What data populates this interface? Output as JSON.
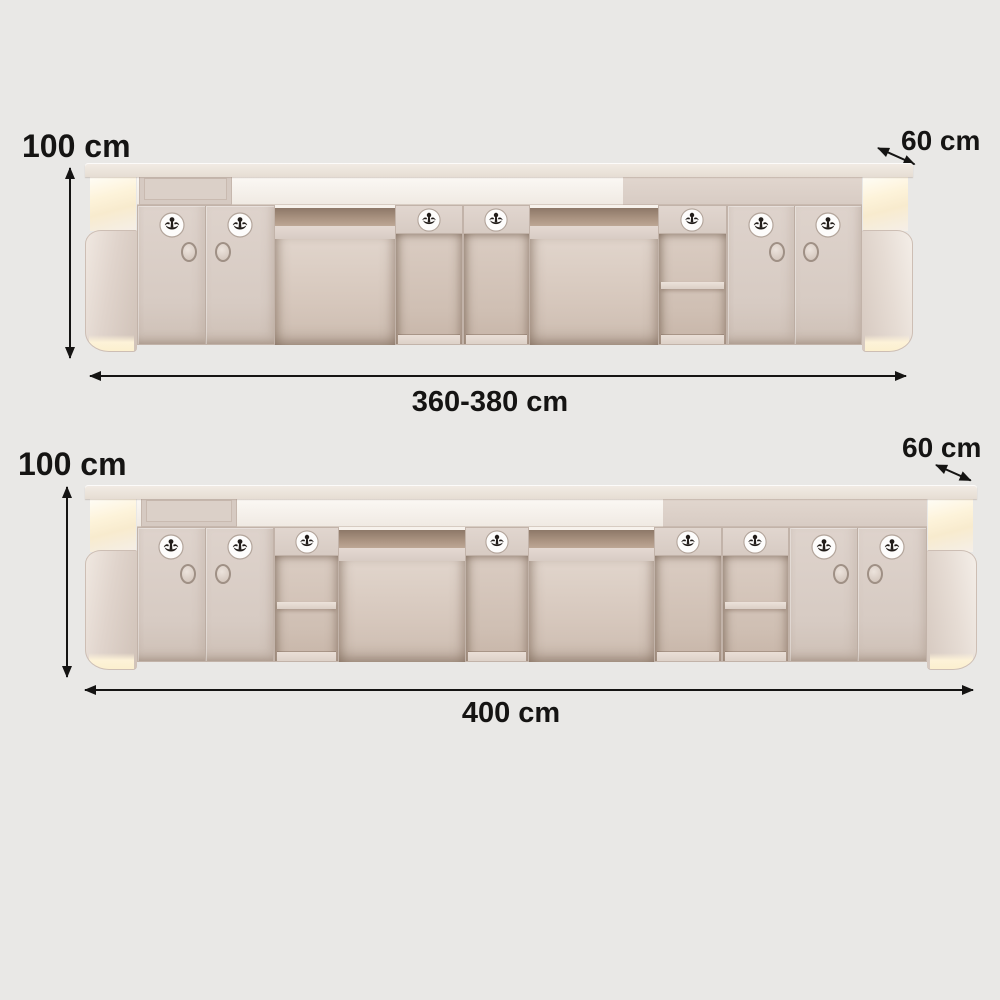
{
  "page": {
    "background_color": "#e9e8e6",
    "description": "Reception counter size diagram, back view, two width options"
  },
  "colors": {
    "bg": "#e9e8e6",
    "ink": "#151413",
    "body": "#dcd1c9",
    "body_dark": "#c2b3a9",
    "interior": "#d5c6bb",
    "counter_white": "#faf7f3",
    "surface": "#e9e1d8",
    "glow": "#fdf2d8"
  },
  "diagrams": [
    {
      "id": "top",
      "height_label": "100 cm",
      "depth_label": "60 cm",
      "width_label": "360-380 cm",
      "counter": {
        "split_pct": 65,
        "panel_x_pct": 6.5,
        "panel_w_pct": 11
      },
      "modules": [
        {
          "type": "cap-left",
          "x": 0,
          "w": 6.3
        },
        {
          "type": "cabinet",
          "x": 6.3,
          "w": 16.6
        },
        {
          "type": "desk",
          "x": 22.9,
          "w": 14.5
        },
        {
          "type": "cubby",
          "x": 37.4,
          "w": 8.2
        },
        {
          "type": "cubby",
          "x": 45.6,
          "w": 8.1
        },
        {
          "type": "desk",
          "x": 53.7,
          "w": 15.5
        },
        {
          "type": "cubby-shelf",
          "x": 69.2,
          "w": 8.3
        },
        {
          "type": "cabinet",
          "x": 77.5,
          "w": 16.3
        },
        {
          "type": "cap-right",
          "x": 93.8,
          "w": 6.2
        }
      ]
    },
    {
      "id": "bottom",
      "height_label": "100 cm",
      "depth_label": "60 cm",
      "width_label": "400 cm",
      "counter": {
        "split_pct": 64.8,
        "panel_x_pct": 6.3,
        "panel_w_pct": 10.5
      },
      "modules": [
        {
          "type": "cap-left",
          "x": 0,
          "w": 5.8
        },
        {
          "type": "cabinet",
          "x": 5.8,
          "w": 15.4
        },
        {
          "type": "cubby-shelf",
          "x": 21.2,
          "w": 7.3
        },
        {
          "type": "desk",
          "x": 28.5,
          "w": 14.1
        },
        {
          "type": "cubby",
          "x": 42.6,
          "w": 7.2
        },
        {
          "type": "desk",
          "x": 49.8,
          "w": 14.0
        },
        {
          "type": "cubby",
          "x": 63.8,
          "w": 7.6
        },
        {
          "type": "cubby-shelf",
          "x": 71.4,
          "w": 7.5
        },
        {
          "type": "cabinet",
          "x": 78.9,
          "w": 15.5
        },
        {
          "type": "cap-right",
          "x": 94.4,
          "w": 5.6
        }
      ]
    }
  ]
}
